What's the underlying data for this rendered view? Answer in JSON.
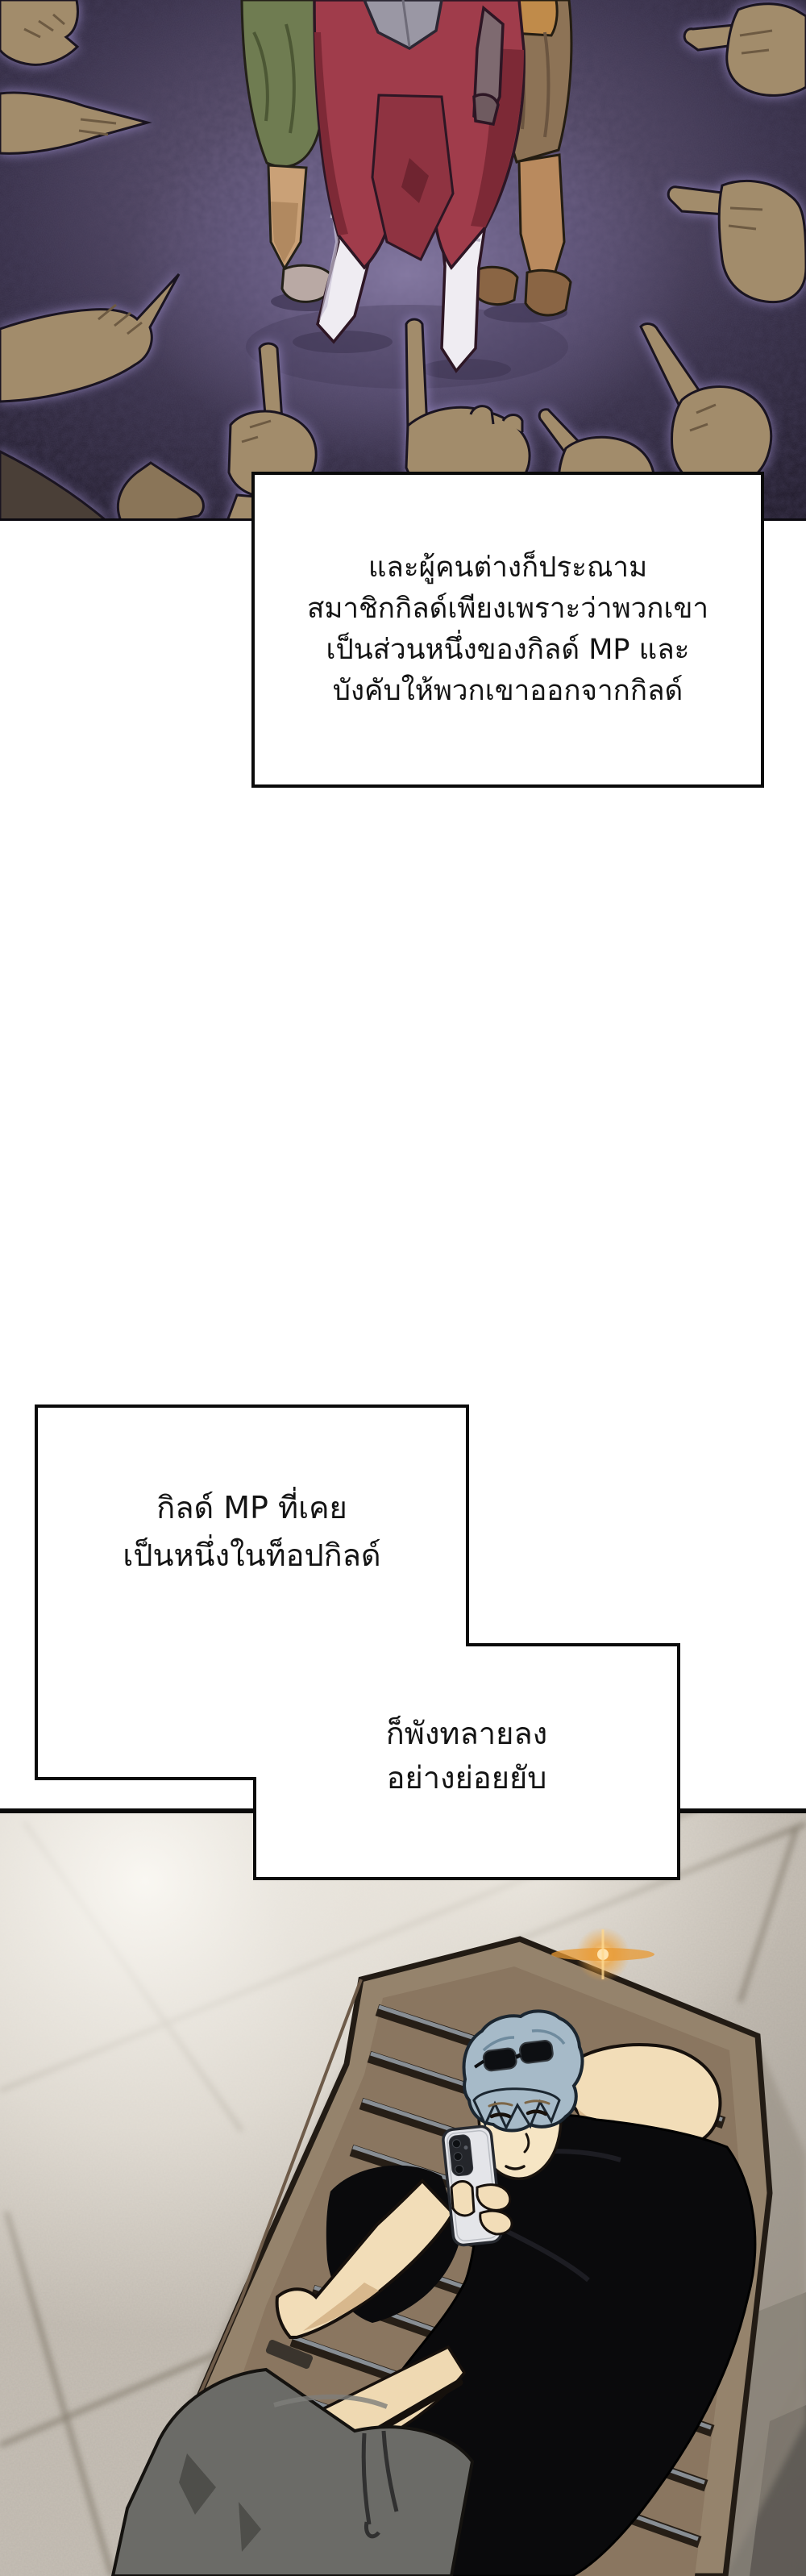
{
  "narration_boxes": [
    {
      "lines": [
        "และผู้คนต่างก็ประณาม",
        "สมาชิกกิลด์เพียงเพราะว่าพวกเขา",
        "เป็นส่วนหนึ่งของกิลด์ MP และ",
        "บังคับให้พวกเขาออกจากกิลด์"
      ]
    },
    {
      "lines": [
        "กิลด์ MP ที่เคย",
        "เป็นหนึ่งในท็อปกิลด์"
      ]
    },
    {
      "lines": [
        "ก็พังทลายลง",
        "อย่างย่อยยับ"
      ]
    }
  ],
  "palette": {
    "page_bg": "#ffffff",
    "box_fill": "#ffffff",
    "box_border": "#0a0a0a",
    "panel1_dark": "#241e2c",
    "panel1_glow": "#7b6f93",
    "hand_skin": "#a28c6b",
    "hand_shadow": "#6d5a42",
    "knight_red": "#a03c4b",
    "armor_white": "#efecf2",
    "green_garment": "#6f7c51",
    "brown_garment": "#8d7356",
    "tile_mid": "#c6bfb5",
    "tile_seam": "#7a7264",
    "lounger_wood": "#95836c",
    "slat_gap": "#261e16",
    "slat_metal": "#8e949b",
    "hair_blue": "#a6bac8",
    "skin": "#f2ddb8",
    "shirt_black": "#0a0a0c",
    "pants_grey": "#6b6b67",
    "phone_body": "#e4e5e9",
    "flare_orange": "#f0a43c"
  }
}
